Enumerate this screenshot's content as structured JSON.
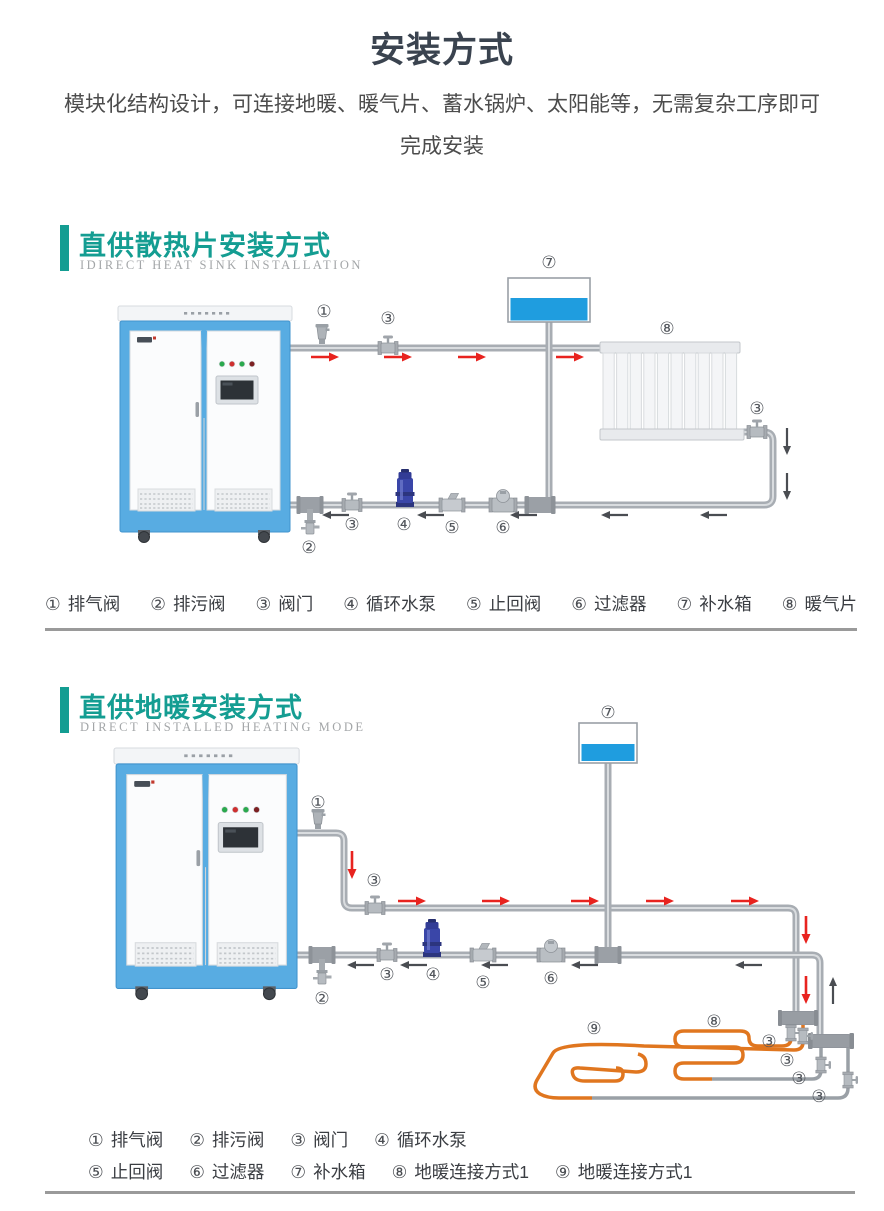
{
  "page": {
    "title": "安装方式",
    "subtitle_line1": "模块化结构设计，可连接地暖、暖气片、蓄水锅炉、太阳能等，无需复杂工序即可",
    "subtitle_line2": "完成安装"
  },
  "colors": {
    "accent_teal": "#149d92",
    "pipe_gray": "#a8adb3",
    "boiler_blue": "#58ace2",
    "water_blue": "#1f9ddf",
    "pump_blue": "#3a46a8",
    "coil_orange": "#e0761f",
    "arrow_red": "#e8231f",
    "arrow_dark": "#4a4d52",
    "divider_gray": "#9a9a9a"
  },
  "section1": {
    "title": "直供散热片安装方式",
    "subtitle_en": "IDIRECT HEAT SINK INSTALLATION",
    "diagram_labels": {
      "airvalve": "①",
      "valve_top": "③",
      "tank": "⑦",
      "radiator": "⑧",
      "valve_right": "③",
      "blowdown": "②",
      "valve_bottom": "③",
      "pump": "④",
      "check": "⑤",
      "filter": "⑥"
    },
    "legend": [
      {
        "num": "①",
        "label": "排气阀"
      },
      {
        "num": "②",
        "label": "排污阀"
      },
      {
        "num": "③",
        "label": "阀门"
      },
      {
        "num": "④",
        "label": "循环水泵"
      },
      {
        "num": "⑤",
        "label": "止回阀"
      },
      {
        "num": "⑥",
        "label": "过滤器"
      },
      {
        "num": "⑦",
        "label": "补水箱"
      },
      {
        "num": "⑧",
        "label": "暖气片"
      }
    ]
  },
  "section2": {
    "title": "直供地暖安装方式",
    "subtitle_en": "DIRECT INSTALLED HEATING MODE",
    "diagram_labels": {
      "airvalve": "①",
      "blowdown": "②",
      "valve_top": "③",
      "valve_bottom": "③",
      "pump": "④",
      "check": "⑤",
      "filter": "⑥",
      "tank": "⑦",
      "coil8": "⑧",
      "coil9": "⑨",
      "coil_valve1": "③",
      "coil_valve2": "③",
      "coil_valve3": "③",
      "coil_valve4": "③"
    },
    "legend_row1": [
      {
        "num": "①",
        "label": "排气阀"
      },
      {
        "num": "②",
        "label": "排污阀"
      },
      {
        "num": "③",
        "label": "阀门"
      },
      {
        "num": "④",
        "label": "循环水泵"
      }
    ],
    "legend_row2": [
      {
        "num": "⑤",
        "label": "止回阀"
      },
      {
        "num": "⑥",
        "label": "过滤器"
      },
      {
        "num": "⑦",
        "label": "补水箱"
      },
      {
        "num": "⑧",
        "label": "地暖连接方式1"
      },
      {
        "num": "⑨",
        "label": "地暖连接方式1"
      }
    ]
  }
}
